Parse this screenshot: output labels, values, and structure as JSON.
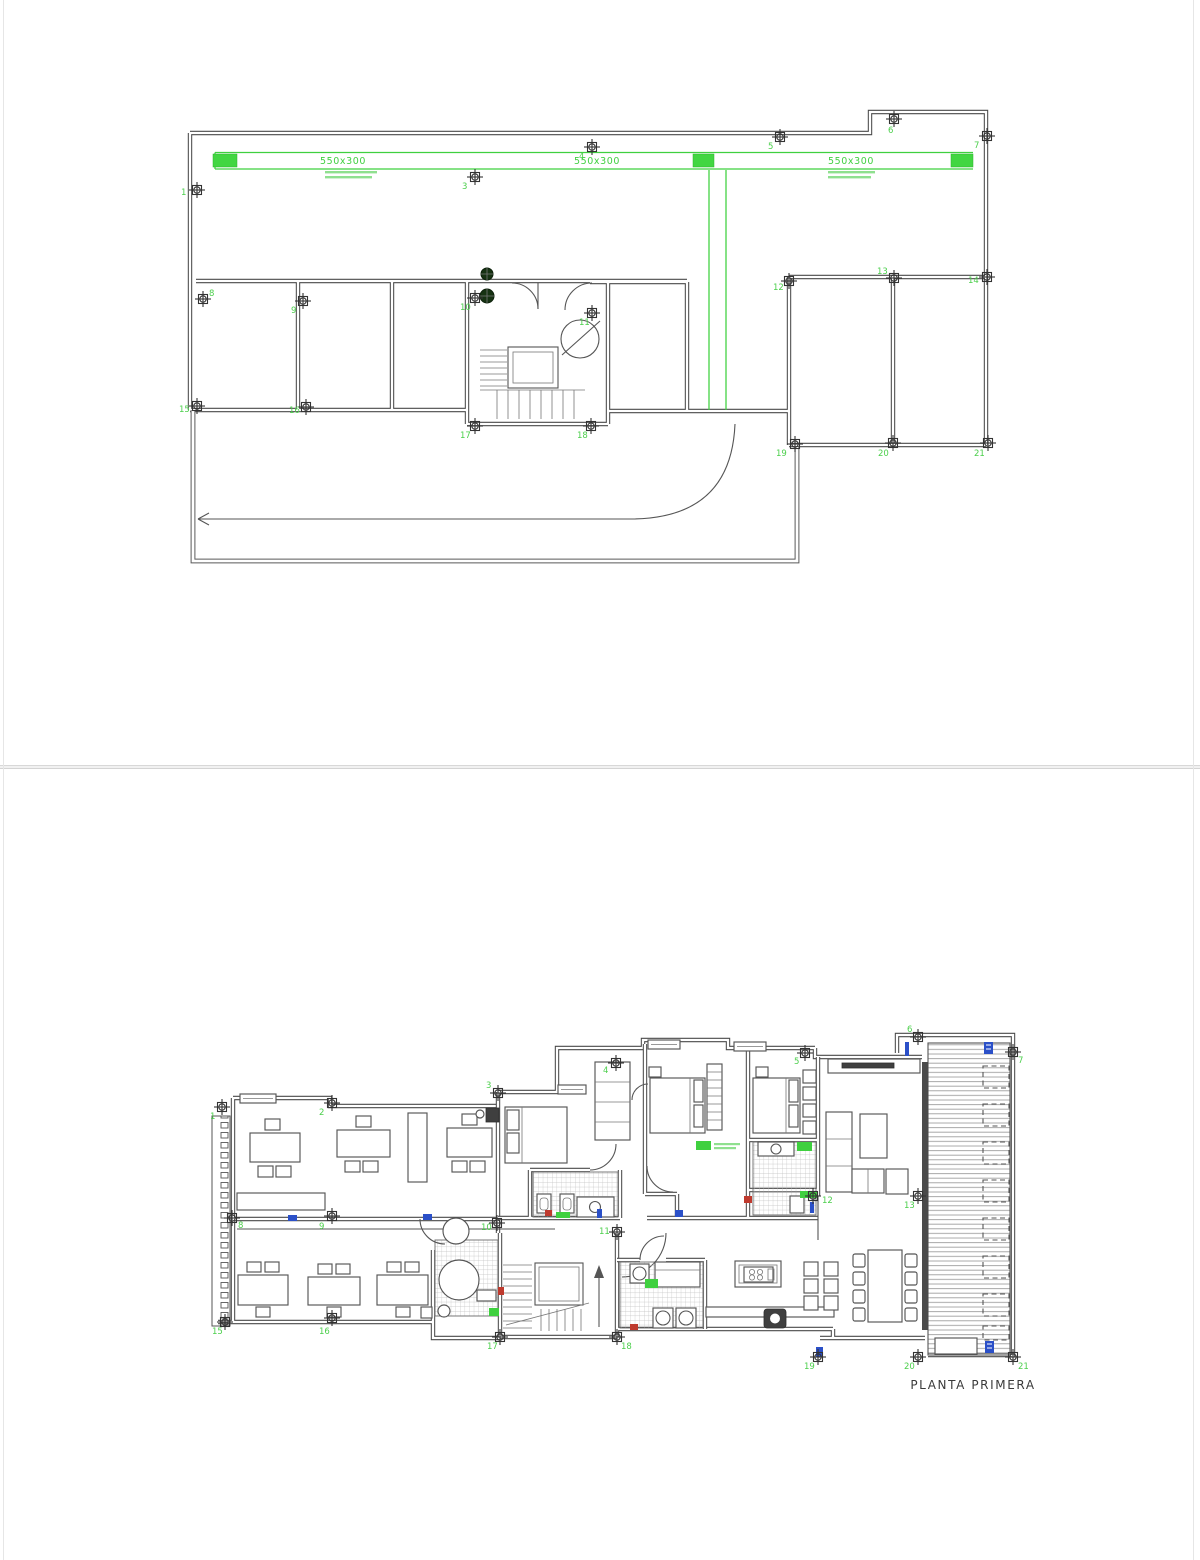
{
  "page1": {
    "duct_labels": [
      "550x300",
      "550x300",
      "550x300"
    ],
    "markers": [
      "1",
      "3",
      "4",
      "5",
      "6",
      "7",
      "8",
      "9",
      "10",
      "11",
      "12",
      "13",
      "14",
      "15",
      "16",
      "17",
      "18",
      "19",
      "20",
      "21"
    ]
  },
  "page2": {
    "title": "PLANTA PRIMERA",
    "markers": [
      "1",
      "2",
      "3",
      "4",
      "5",
      "6",
      "7",
      "8",
      "9",
      "10",
      "11",
      "12",
      "13",
      "15",
      "16",
      "17",
      "18",
      "19",
      "20",
      "21"
    ]
  },
  "colors": {
    "cad_green": "#3fd03f",
    "wall_gray": "#4a4a4a",
    "accent_blue": "#2b50c8",
    "accent_red": "#bf3a2e"
  }
}
